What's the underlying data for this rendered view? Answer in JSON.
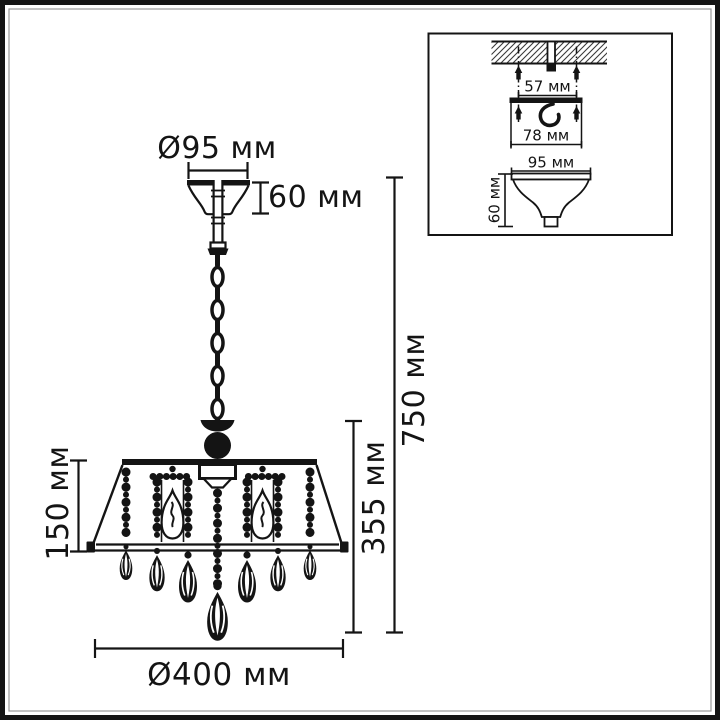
{
  "page": {
    "background": "#ffffff",
    "line_color": "#141414",
    "border_inner_color": "#9a9a9a"
  },
  "main_view": {
    "labels": {
      "top_diameter": "Ø95 мм",
      "canopy_height": "60 мм",
      "shade_height": "150 мм",
      "fixture_height": "355 мм",
      "total_height": "750 мм",
      "bottom_diameter": "Ø400 мм"
    }
  },
  "inset_view": {
    "labels": {
      "anchor_spacing": "57 мм",
      "plate_width": "78 мм",
      "canopy_diameter": "95 мм",
      "canopy_height": "60 мм"
    }
  }
}
